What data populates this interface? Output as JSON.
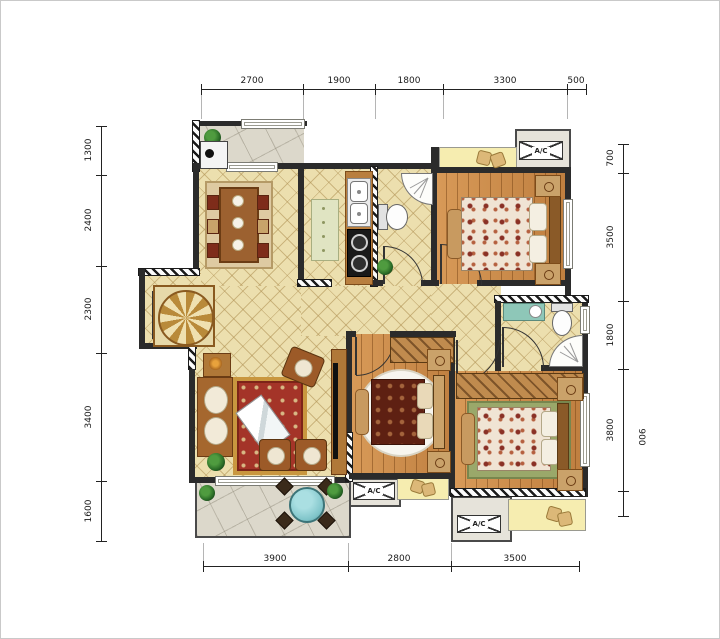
{
  "title": "apartment-floor-plan",
  "dimensions": {
    "top": [
      "2700",
      "1900",
      "1800",
      "3300",
      "500"
    ],
    "left": [
      "1300",
      "2400",
      "2300",
      "3400",
      "1600"
    ],
    "right": [
      "700",
      "3500",
      "1800",
      "3800"
    ],
    "right_offset": "900",
    "bottom": [
      "3900",
      "2800",
      "3500"
    ]
  },
  "labels": {
    "ac_unit": "A/C"
  },
  "colors": {
    "wall": "#2b2b2b",
    "tile_floor": "#ecdfae",
    "wood_floor": "#cd9354",
    "balcony_floor": "#dcd8cb",
    "bay_window": "#f6edb0",
    "rug_red": "#a43428",
    "rug_green": "#9aa86a",
    "bed_dark": "#5e2012",
    "balcony_table_teal": "#7fc4c9"
  }
}
